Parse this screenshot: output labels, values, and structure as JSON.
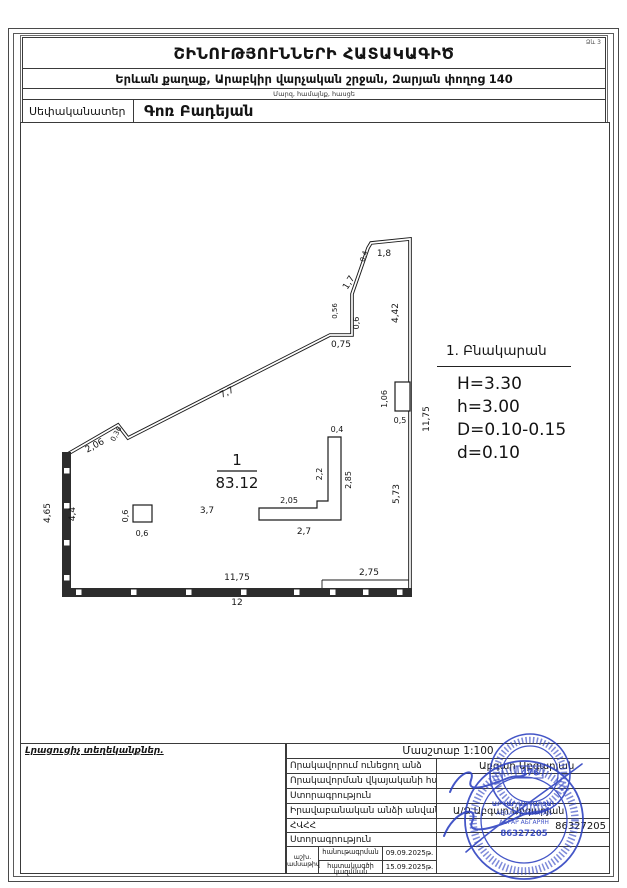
{
  "form_no": "Ձև 3",
  "header": {
    "title": "ՇԻՆՈՒԹՅՈՒՆՆԵՐԻ ՀԱՏԱԿԱԳԻԾ",
    "address": "Երևան քաղաք, Արաբկիր վարչական շրջան, Զարյան փողոց 140",
    "address_caption": "Մարզ, համայնք, հասցե",
    "owner_label": "Սեփականատեր",
    "owner_value": "Գոռ Բադեյան"
  },
  "plan": {
    "room_number": "1",
    "room_area": "83.12",
    "dimensions": [
      {
        "t": "1,8",
        "x": 384,
        "y": 256
      },
      {
        "t": "0,4",
        "x": 366,
        "y": 257,
        "r": -72,
        "s": 7
      },
      {
        "t": "1,7",
        "x": 351,
        "y": 284,
        "r": -58
      },
      {
        "t": "0,56",
        "x": 337,
        "y": 311,
        "r": -90,
        "s": 7
      },
      {
        "t": "0,6",
        "x": 359,
        "y": 323,
        "r": -90,
        "s": 8
      },
      {
        "t": "0,75",
        "x": 341,
        "y": 347
      },
      {
        "t": "4,42",
        "x": 398,
        "y": 313,
        "r": -90
      },
      {
        "t": "7,7",
        "x": 228,
        "y": 395,
        "r": -26
      },
      {
        "t": "0,36",
        "x": 118,
        "y": 435,
        "r": -62,
        "s": 7
      },
      {
        "t": "2,06",
        "x": 96,
        "y": 448,
        "r": -28
      },
      {
        "t": "4,65",
        "x": 50,
        "y": 513,
        "r": -90
      },
      {
        "t": "4,4",
        "x": 75,
        "y": 514,
        "r": -90
      },
      {
        "t": "0,6",
        "x": 128,
        "y": 516,
        "r": -90,
        "s": 8
      },
      {
        "t": "0,6",
        "x": 142,
        "y": 536,
        "s": 8
      },
      {
        "t": "3,7",
        "x": 207,
        "y": 513
      },
      {
        "t": "1,06",
        "x": 387,
        "y": 399,
        "r": -90,
        "s": 8
      },
      {
        "t": "0,5",
        "x": 400,
        "y": 423,
        "s": 8
      },
      {
        "t": "11,75",
        "x": 429,
        "y": 419,
        "r": -90
      },
      {
        "t": "5,73",
        "x": 399,
        "y": 494,
        "r": -90
      },
      {
        "t": "0,4",
        "x": 337,
        "y": 432,
        "s": 8
      },
      {
        "t": "2,2",
        "x": 322,
        "y": 474,
        "r": -90,
        "s": 8
      },
      {
        "t": "2,85",
        "x": 351,
        "y": 480,
        "r": -90,
        "s": 8
      },
      {
        "t": "2,05",
        "x": 289,
        "y": 503,
        "s": 8
      },
      {
        "t": "2,7",
        "x": 304,
        "y": 534
      },
      {
        "t": "2,75",
        "x": 369,
        "y": 575
      },
      {
        "t": "11,75",
        "x": 237,
        "y": 580
      },
      {
        "t": "12",
        "x": 237,
        "y": 605
      }
    ]
  },
  "legend": {
    "title": "1. Բնակարան",
    "lines": [
      "H=3.30",
      "h=3.00",
      "D=0.10-0.15",
      "d=0.10"
    ]
  },
  "footer": {
    "extra_info_label": "Լրացուցիչ տեղեկանքներ.",
    "scale_label": "Մասշտաբ 1:100",
    "rows": [
      {
        "label": "Որակավորում ունեցող անձ",
        "value": "Աբգար Աբգարյան"
      },
      {
        "label": "Որակավորման վկայականի համար",
        "value": ""
      },
      {
        "label": "Ստորագրություն",
        "value": ""
      },
      {
        "label": "Իրավաբանական անձի անվանում",
        "value": "Ա/Ձ Աբգար Աբգարյան"
      },
      {
        "label": "ՀՎՀՀ",
        "value": "86327205"
      },
      {
        "label": "Ստորագրություն",
        "value": ""
      }
    ],
    "date_row": {
      "col_label_line1": "աշխ.",
      "col_label_line2": "ամսաթիվ",
      "survey_label": "հանութագրման",
      "plan_label": "հատակագծի կազմման",
      "survey_date": "09.09.2025թ.",
      "plan_date": "15.09.2025թ."
    }
  },
  "stamp": {
    "number": "476",
    "lines": [
      "ԱԲԳԱՐ ԱԲԳԱՐՅԱՆ",
      "ABGAR ABGARYAN",
      "АБГАР АБГАРЯН",
      "86327205"
    ],
    "color": "#2b3fc0"
  }
}
